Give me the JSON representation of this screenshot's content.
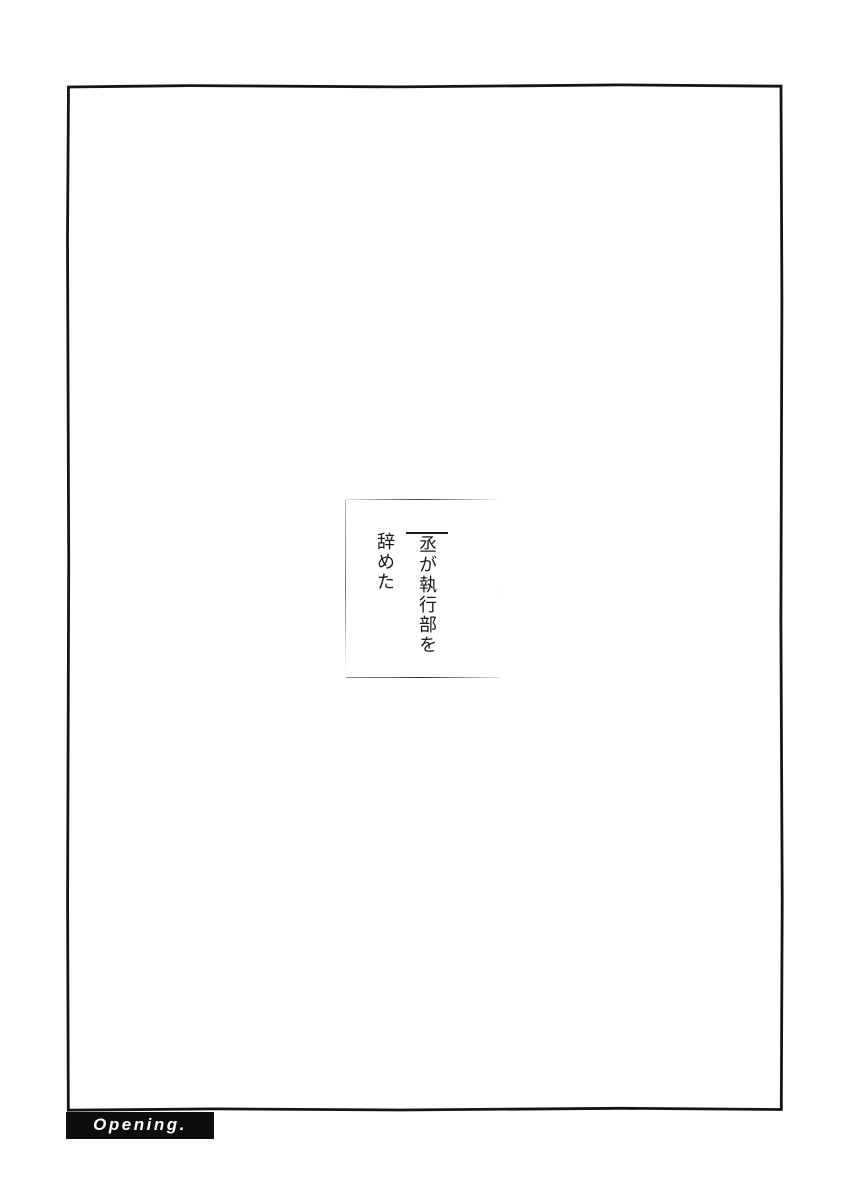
{
  "panel": {
    "dialogue": {
      "name": "丞",
      "line1_rest": "が執行部を",
      "line2": "辞めた"
    },
    "caption": {
      "label": "Opening."
    }
  },
  "colors": {
    "ink": "#1a1a1a",
    "paper": "#ffffff",
    "caption_bg": "#0d0d0d",
    "caption_text": "#ffffff"
  }
}
